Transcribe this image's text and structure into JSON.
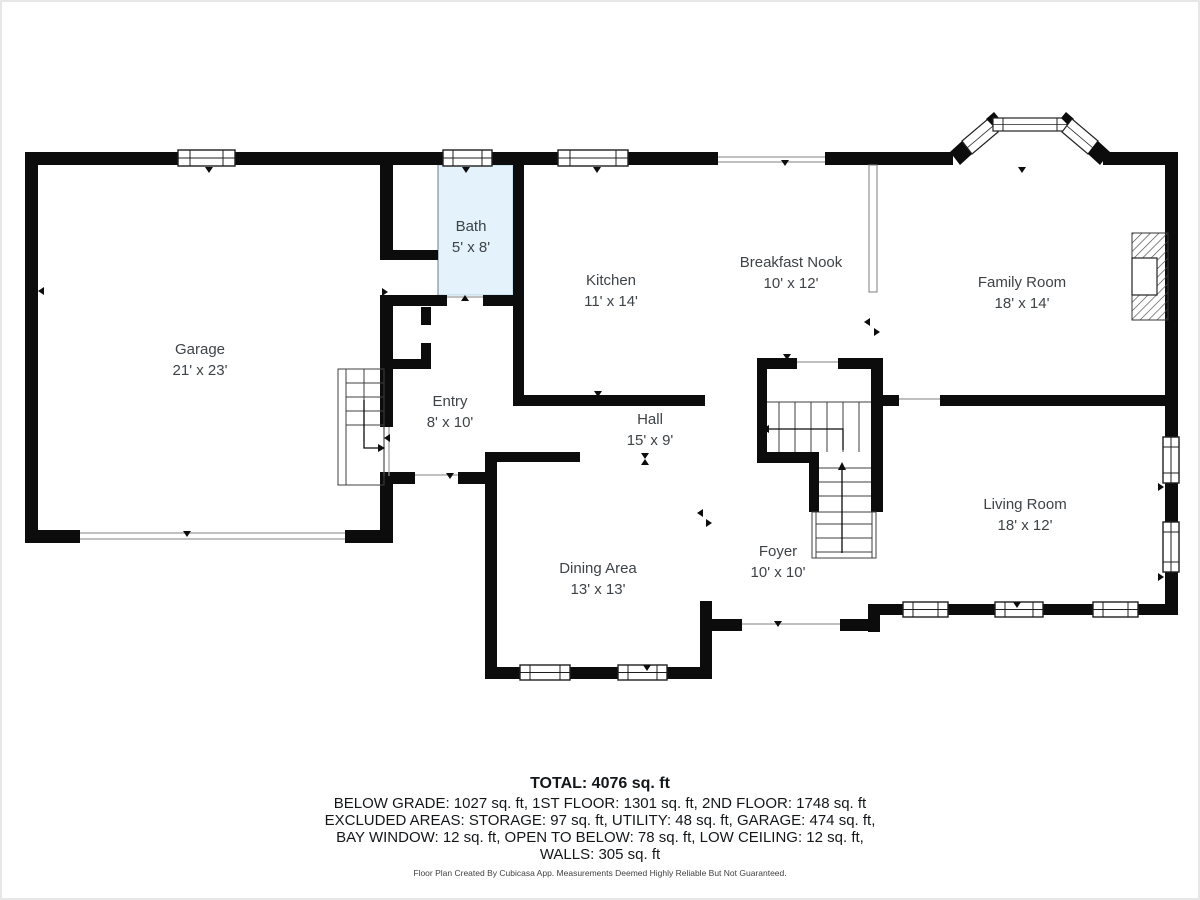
{
  "rooms": {
    "garage": {
      "name": "Garage",
      "dims": "21' x 23'"
    },
    "bath": {
      "name": "Bath",
      "dims": "5' x 8'"
    },
    "kitchen": {
      "name": "Kitchen",
      "dims": "11' x 14'"
    },
    "breakfast_nook": {
      "name": "Breakfast Nook",
      "dims": "10' x 12'"
    },
    "family_room": {
      "name": "Family Room",
      "dims": "18' x 14'"
    },
    "entry": {
      "name": "Entry",
      "dims": "8' x 10'"
    },
    "hall": {
      "name": "Hall",
      "dims": "15' x 9'"
    },
    "dining_area": {
      "name": "Dining Area",
      "dims": "13' x 13'"
    },
    "foyer": {
      "name": "Foyer",
      "dims": "10' x 10'"
    },
    "living_room": {
      "name": "Living Room",
      "dims": "18' x 12'"
    }
  },
  "summary": {
    "total": "TOTAL: 4076 sq. ft",
    "lines": [
      "BELOW GRADE: 1027 sq. ft, 1ST FLOOR: 1301 sq. ft, 2ND FLOOR: 1748 sq. ft",
      "EXCLUDED AREAS: STORAGE: 97 sq. ft, UTILITY: 48 sq. ft, GARAGE: 474 sq. ft,",
      "BAY WINDOW: 12 sq. ft, OPEN TO BELOW: 78 sq. ft, LOW CEILING: 12 sq. ft,",
      "WALLS: 305 sq. ft"
    ]
  },
  "footer": "Floor Plan Created By Cubicasa App. Measurements Deemed Highly Reliable But Not Guaranteed.",
  "colors": {
    "wall": "#0c0c0c",
    "bath_fill": "#e3f2fb",
    "label_text": "#3e4347"
  }
}
